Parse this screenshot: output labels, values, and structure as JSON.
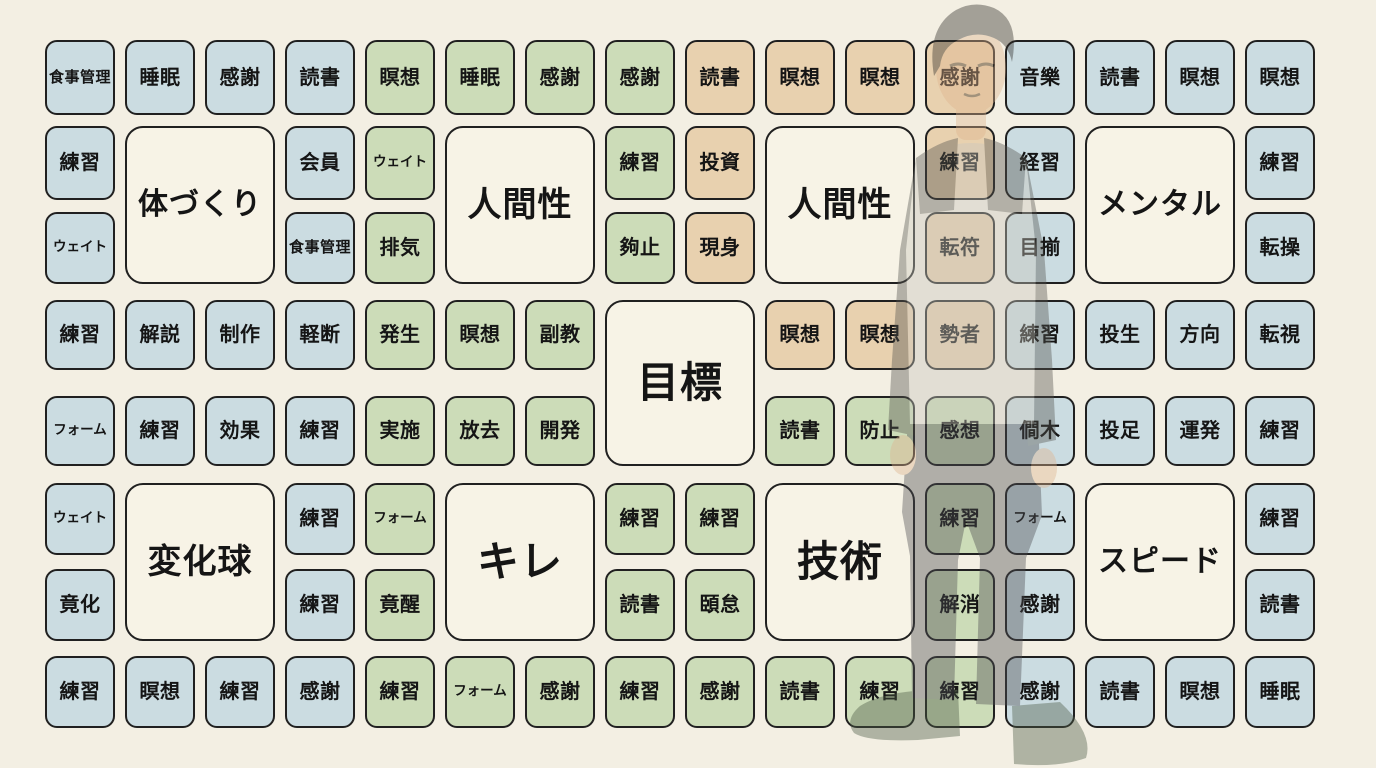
{
  "title": "goal-mandala-chart",
  "colors": {
    "background": "#f3efe3",
    "cell_blue": "#cbdce1",
    "cell_green": "#ccdcb8",
    "cell_tan": "#e8d1af",
    "cell_theme": "#f7f3e6",
    "border": "#202020",
    "text": "#151515",
    "figure_hair": "#2e2b27",
    "figure_skin": "#dfb48e",
    "figure_shirt": "#c9c7be",
    "figure_dark": "#55544f",
    "figure_pants": "#4e4e52",
    "figure_shoes": "#4b5a45"
  },
  "grid": {
    "cells": [
      {
        "row": 0,
        "col": 0,
        "label": "食事管理",
        "color": "blue"
      },
      {
        "row": 0,
        "col": 1,
        "label": "睡眠",
        "color": "blue"
      },
      {
        "row": 0,
        "col": 2,
        "label": "感謝",
        "color": "blue"
      },
      {
        "row": 0,
        "col": 3,
        "label": "読書",
        "color": "blue"
      },
      {
        "row": 0,
        "col": 4,
        "label": "瞑想",
        "color": "green"
      },
      {
        "row": 0,
        "col": 5,
        "label": "睡眠",
        "color": "green"
      },
      {
        "row": 0,
        "col": 6,
        "label": "感謝",
        "color": "green"
      },
      {
        "row": 0,
        "col": 7,
        "label": "感謝",
        "color": "green"
      },
      {
        "row": 0,
        "col": 8,
        "label": "読書",
        "color": "tan"
      },
      {
        "row": 0,
        "col": 9,
        "label": "瞑想",
        "color": "tan"
      },
      {
        "row": 0,
        "col": 10,
        "label": "瞑想",
        "color": "tan"
      },
      {
        "row": 0,
        "col": 11,
        "label": "感謝",
        "color": "tan"
      },
      {
        "row": 0,
        "col": 12,
        "label": "音樂",
        "color": "blue"
      },
      {
        "row": 0,
        "col": 13,
        "label": "読書",
        "color": "blue"
      },
      {
        "row": 0,
        "col": 14,
        "label": "瞑想",
        "color": "blue"
      },
      {
        "row": 0,
        "col": 15,
        "label": "瞑想",
        "color": "blue"
      },
      {
        "row": 1,
        "col": 0,
        "label": "練習",
        "color": "blue"
      },
      {
        "row": 1,
        "col": 3,
        "label": "会員",
        "color": "blue"
      },
      {
        "row": 1,
        "col": 4,
        "label": "ウェイト",
        "color": "green"
      },
      {
        "row": 1,
        "col": 7,
        "label": "練習",
        "color": "green"
      },
      {
        "row": 1,
        "col": 8,
        "label": "投資",
        "color": "tan"
      },
      {
        "row": 1,
        "col": 11,
        "label": "練習",
        "color": "tan"
      },
      {
        "row": 1,
        "col": 12,
        "label": "経習",
        "color": "blue"
      },
      {
        "row": 1,
        "col": 15,
        "label": "練習",
        "color": "blue"
      },
      {
        "row": 2,
        "col": 0,
        "label": "ウェイト",
        "color": "blue"
      },
      {
        "row": 2,
        "col": 3,
        "label": "食事管理",
        "color": "blue"
      },
      {
        "row": 2,
        "col": 4,
        "label": "排気",
        "color": "green"
      },
      {
        "row": 2,
        "col": 7,
        "label": "夠止",
        "color": "green"
      },
      {
        "row": 2,
        "col": 8,
        "label": "現身",
        "color": "tan"
      },
      {
        "row": 2,
        "col": 11,
        "label": "転符",
        "color": "tan"
      },
      {
        "row": 2,
        "col": 12,
        "label": "目揃",
        "color": "blue"
      },
      {
        "row": 2,
        "col": 15,
        "label": "転操",
        "color": "blue"
      },
      {
        "row": 3,
        "col": 0,
        "label": "練習",
        "color": "blue"
      },
      {
        "row": 3,
        "col": 1,
        "label": "解説",
        "color": "blue"
      },
      {
        "row": 3,
        "col": 2,
        "label": "制作",
        "color": "blue"
      },
      {
        "row": 3,
        "col": 3,
        "label": "軽断",
        "color": "blue"
      },
      {
        "row": 3,
        "col": 4,
        "label": "発生",
        "color": "green"
      },
      {
        "row": 3,
        "col": 5,
        "label": "瞑想",
        "color": "green"
      },
      {
        "row": 3,
        "col": 6,
        "label": "副教",
        "color": "green"
      },
      {
        "row": 3,
        "col": 9,
        "label": "瞑想",
        "color": "tan"
      },
      {
        "row": 3,
        "col": 10,
        "label": "瞑想",
        "color": "tan"
      },
      {
        "row": 3,
        "col": 11,
        "label": "勢者",
        "color": "tan"
      },
      {
        "row": 3,
        "col": 12,
        "label": "練習",
        "color": "blue"
      },
      {
        "row": 3,
        "col": 13,
        "label": "投生",
        "color": "blue"
      },
      {
        "row": 3,
        "col": 14,
        "label": "方向",
        "color": "blue"
      },
      {
        "row": 3,
        "col": 15,
        "label": "転視",
        "color": "blue"
      },
      {
        "row": 4,
        "col": 0,
        "label": "フォーム",
        "color": "blue"
      },
      {
        "row": 4,
        "col": 1,
        "label": "練習",
        "color": "blue"
      },
      {
        "row": 4,
        "col": 2,
        "label": "効果",
        "color": "blue"
      },
      {
        "row": 4,
        "col": 3,
        "label": "練習",
        "color": "blue"
      },
      {
        "row": 4,
        "col": 4,
        "label": "実施",
        "color": "green"
      },
      {
        "row": 4,
        "col": 5,
        "label": "放去",
        "color": "green"
      },
      {
        "row": 4,
        "col": 6,
        "label": "開発",
        "color": "green"
      },
      {
        "row": 4,
        "col": 9,
        "label": "読書",
        "color": "green"
      },
      {
        "row": 4,
        "col": 10,
        "label": "防止",
        "color": "green"
      },
      {
        "row": 4,
        "col": 11,
        "label": "感想",
        "color": "green"
      },
      {
        "row": 4,
        "col": 12,
        "label": "僴木",
        "color": "blue"
      },
      {
        "row": 4,
        "col": 13,
        "label": "投足",
        "color": "blue"
      },
      {
        "row": 4,
        "col": 14,
        "label": "運発",
        "color": "blue"
      },
      {
        "row": 4,
        "col": 15,
        "label": "練習",
        "color": "blue"
      },
      {
        "row": 5,
        "col": 0,
        "label": "ウェイト",
        "color": "blue"
      },
      {
        "row": 5,
        "col": 3,
        "label": "練習",
        "color": "blue"
      },
      {
        "row": 5,
        "col": 4,
        "label": "フォーム",
        "color": "green"
      },
      {
        "row": 5,
        "col": 7,
        "label": "練習",
        "color": "green"
      },
      {
        "row": 5,
        "col": 8,
        "label": "練習",
        "color": "green"
      },
      {
        "row": 5,
        "col": 11,
        "label": "練習",
        "color": "green"
      },
      {
        "row": 5,
        "col": 12,
        "label": "フォーム",
        "color": "blue"
      },
      {
        "row": 5,
        "col": 15,
        "label": "練習",
        "color": "blue"
      },
      {
        "row": 6,
        "col": 0,
        "label": "竟化",
        "color": "blue"
      },
      {
        "row": 6,
        "col": 3,
        "label": "練習",
        "color": "blue"
      },
      {
        "row": 6,
        "col": 4,
        "label": "竟醒",
        "color": "green"
      },
      {
        "row": 6,
        "col": 7,
        "label": "読書",
        "color": "green"
      },
      {
        "row": 6,
        "col": 8,
        "label": "頣怠",
        "color": "green"
      },
      {
        "row": 6,
        "col": 11,
        "label": "解消",
        "color": "green"
      },
      {
        "row": 6,
        "col": 12,
        "label": "感謝",
        "color": "blue"
      },
      {
        "row": 6,
        "col": 15,
        "label": "読書",
        "color": "blue"
      },
      {
        "row": 7,
        "col": 0,
        "label": "練習",
        "color": "blue"
      },
      {
        "row": 7,
        "col": 1,
        "label": "瞑想",
        "color": "blue"
      },
      {
        "row": 7,
        "col": 2,
        "label": "練習",
        "color": "blue"
      },
      {
        "row": 7,
        "col": 3,
        "label": "感謝",
        "color": "blue"
      },
      {
        "row": 7,
        "col": 4,
        "label": "練習",
        "color": "green"
      },
      {
        "row": 7,
        "col": 5,
        "label": "フォーム",
        "color": "green"
      },
      {
        "row": 7,
        "col": 6,
        "label": "感謝",
        "color": "green"
      },
      {
        "row": 7,
        "col": 7,
        "label": "練習",
        "color": "green"
      },
      {
        "row": 7,
        "col": 8,
        "label": "感謝",
        "color": "green"
      },
      {
        "row": 7,
        "col": 9,
        "label": "読書",
        "color": "green"
      },
      {
        "row": 7,
        "col": 10,
        "label": "練習",
        "color": "green"
      },
      {
        "row": 7,
        "col": 11,
        "label": "練習",
        "color": "green"
      },
      {
        "row": 7,
        "col": 12,
        "label": "感謝",
        "color": "blue"
      },
      {
        "row": 7,
        "col": 13,
        "label": "読書",
        "color": "blue"
      },
      {
        "row": 7,
        "col": 14,
        "label": "瞑想",
        "color": "blue"
      },
      {
        "row": 7,
        "col": 15,
        "label": "睡眠",
        "color": "blue"
      }
    ],
    "theme_cells": [
      {
        "row": 1,
        "col": 1,
        "label": "体づくり"
      },
      {
        "row": 1,
        "col": 5,
        "label": "人間性"
      },
      {
        "row": 1,
        "col": 9,
        "label": "人間性"
      },
      {
        "row": 1,
        "col": 13,
        "label": "メンタル"
      },
      {
        "row": 3,
        "col": 7,
        "label": "目標"
      },
      {
        "row": 5,
        "col": 1,
        "label": "変化球"
      },
      {
        "row": 5,
        "col": 5,
        "label": "キレ"
      },
      {
        "row": 5,
        "col": 9,
        "label": "技術"
      },
      {
        "row": 5,
        "col": 13,
        "label": "スピード"
      }
    ]
  },
  "figure": {
    "type": "standing-man-illustration"
  }
}
